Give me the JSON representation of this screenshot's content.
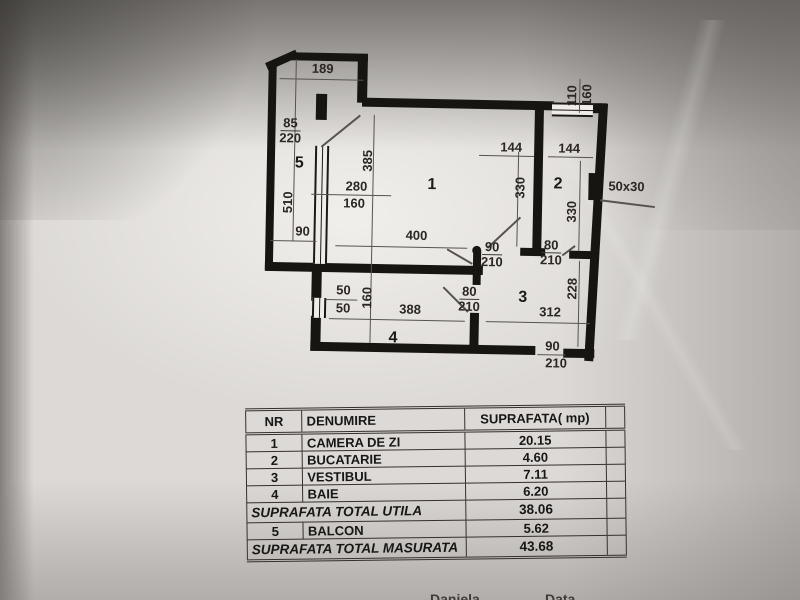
{
  "plan": {
    "rooms": {
      "r1": "1",
      "r2": "2",
      "r3": "3",
      "r4": "4",
      "r5": "5"
    },
    "dims": {
      "d189": "189",
      "d85": "85",
      "d220": "220",
      "d510": "510",
      "d385": "385",
      "d280": "280",
      "d160": "160",
      "d90": "90",
      "d210": "210",
      "d400": "400",
      "d144": "144",
      "d110": "110",
      "d330": "330",
      "d50x30": "50x30",
      "d80": "80",
      "d228": "228",
      "d312": "312",
      "d50": "50",
      "d388": "388"
    },
    "colors": {
      "wall": "#171512",
      "paper": "#dcd9d6",
      "line": "#57534f"
    }
  },
  "table": {
    "headers": [
      "NR",
      "DENUMIRE",
      "SUPRAFATA( mp)"
    ],
    "rows": [
      {
        "nr": "1",
        "name": "CAMERA DE ZI",
        "area": "20.15"
      },
      {
        "nr": "2",
        "name": "BUCATARIE",
        "area": "4.60"
      },
      {
        "nr": "3",
        "name": "VESTIBUL",
        "area": "7.11"
      },
      {
        "nr": "4",
        "name": "BAIE",
        "area": "6.20"
      }
    ],
    "total_utila": {
      "label": "SUPRAFATA TOTAL UTILA",
      "value": "38.06"
    },
    "balcon_row": {
      "nr": "5",
      "name": "BALCON",
      "area": "5.62"
    },
    "total_masurata": {
      "label": "SUPRAFATA TOTAL MASURATA",
      "value": "43.68"
    }
  },
  "footer": {
    "left": "Daniela",
    "right": "Data"
  }
}
